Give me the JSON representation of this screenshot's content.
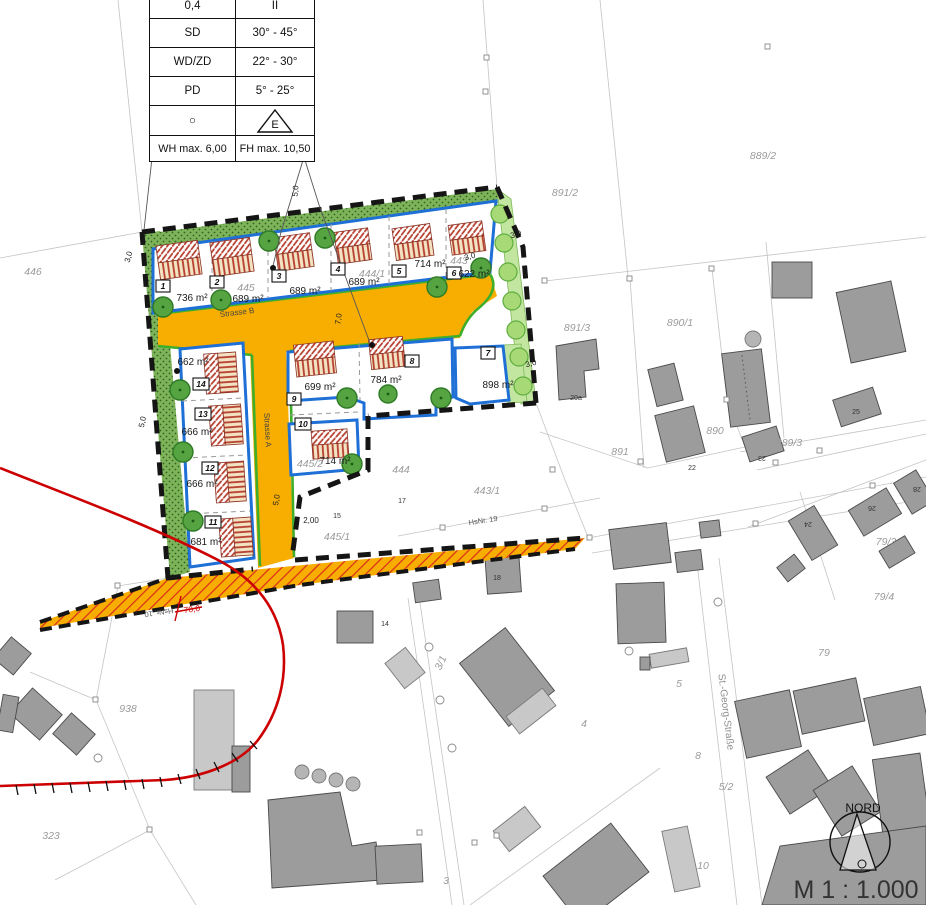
{
  "legend": {
    "rows": [
      {
        "l": "0,4",
        "r": "II"
      },
      {
        "l": "SD",
        "r": "30° - 45°"
      },
      {
        "l": "WD/ZD",
        "r": "22° - 30°"
      },
      {
        "l": "PD",
        "r": "5° - 25°"
      },
      {
        "l": "○",
        "r": ""
      },
      {
        "l": "WH max. 6,00",
        "r": "FH max. 10,50"
      }
    ],
    "e_symbol": "E"
  },
  "lots": [
    {
      "no": "1",
      "area": "736 m²"
    },
    {
      "no": "2",
      "area": "689 m²"
    },
    {
      "no": "3",
      "area": "689 m²"
    },
    {
      "no": "4",
      "area": "689 m²"
    },
    {
      "no": "5",
      "area": "714 m²"
    },
    {
      "no": "6",
      "area": "622 m²"
    },
    {
      "no": "7",
      "area": "898 m²"
    },
    {
      "no": "8",
      "area": "784 m²"
    },
    {
      "no": "9",
      "area": "699 m²"
    },
    {
      "no": "10",
      "area": "714 m²"
    },
    {
      "no": "11",
      "area": "681 m²"
    },
    {
      "no": "12",
      "area": "666 m²"
    },
    {
      "no": "13",
      "area": "666 m²"
    },
    {
      "no": "14",
      "area": "662 m²"
    }
  ],
  "parcels": {
    "a446": "446",
    "a445": "445",
    "a444_1": "444/1",
    "a443": "443",
    "a444": "444",
    "a443_1": "443/1",
    "a445_1": "445/1",
    "a445_2": "445/2",
    "a891_2": "891/2",
    "a889_2": "889/2",
    "a891_3": "891/3",
    "a890_1": "890/1",
    "a890": "890",
    "a891": "891",
    "a889_3": "889/3",
    "a79_3": "79/3",
    "a79_4": "79/4",
    "a79": "79",
    "a938": "938",
    "a323": "323",
    "a3_1": "3/1",
    "a4": "4",
    "a5": "5",
    "a8": "8",
    "a5_2": "5/2",
    "a77": "77",
    "a75": "75",
    "a10": "10",
    "a3": "3"
  },
  "houses": {
    "h20a": "20a",
    "h22": "22",
    "h25": "25",
    "h23": "23",
    "h24": "24",
    "h26": "26",
    "h28": "28",
    "h17": "17",
    "h15": "15",
    "h18": "18",
    "h14": "14"
  },
  "dims": {
    "dim_3_0": "3,0",
    "dim_5_0": "5,0",
    "dim_7_0": "7,0",
    "dim_2_00": "2,00",
    "dim_70_0": "70,0"
  },
  "streets": {
    "strasse_a": "Strasse A",
    "strasse_b": "Strasse B",
    "st_georg": "St.-Georg-Straße"
  },
  "house_refs": {
    "hsnr19": "HsNr. 19",
    "hsnr10": "HsNr. 10"
  },
  "compass": {
    "north_label": "NORD"
  },
  "scale_text": "M 1 : 1.000",
  "colors": {
    "street_orange": "#F8AE00",
    "lot_blue": "#1e6fd6",
    "green_strip": "#7db45a",
    "light_green": "#c2e6a0",
    "green_edge": "#3fae2a",
    "red_line": "#cc0000",
    "roof_red": "#b63e2e",
    "building_grey": "#9c9c9c"
  }
}
